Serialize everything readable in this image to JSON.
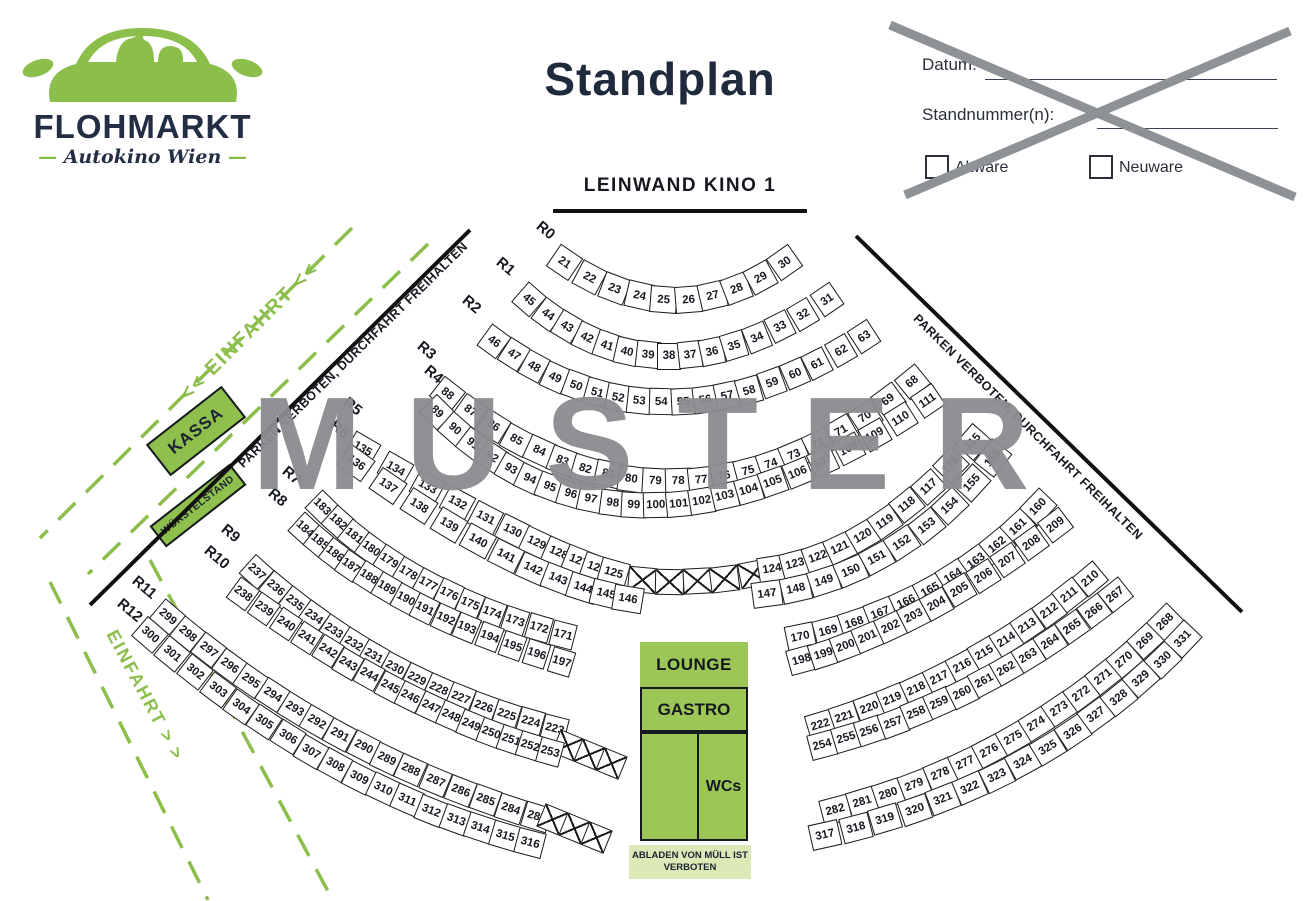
{
  "title": "Standplan",
  "watermark": "MUSTER",
  "screen": {
    "label": "LEINWAND KINO 1"
  },
  "logo": {
    "name": "FLOHMARKT",
    "subtitle": "Autokino Wien"
  },
  "form": {
    "date_label": "Datum:",
    "stand_label": "Standnummer(n):",
    "altware": "Altware",
    "neuware": "Neuware"
  },
  "signs": {
    "kassa": "KASSA",
    "wuerstelstand": "WÜRSTELSTAND",
    "einfahrt_top": "<< EINFAHRT <<",
    "einfahrt_bottom": "EINFAHRT > >",
    "parken_left": "PARKEN VERBOTEN, DURCHFAHRT FREIHALTEN",
    "parken_right": "PARKEN VERBOTEN, DURCHFAHRT FREIHALTEN"
  },
  "facilities": {
    "lounge": "LOUNGE",
    "gastro": "GASTRO",
    "wcs": "WCs",
    "note": "ABLADEN VON MÜLL IST VERBOTEN"
  },
  "colors": {
    "green": "#8cbe4b",
    "block_green": "#9cc655",
    "light_green": "#dbe9b7",
    "navy": "#232e44",
    "gray": "#8a8c8f"
  },
  "row_labels": [
    "R0",
    "R1",
    "R2",
    "R3",
    "R4",
    "R5",
    "R6",
    "R7",
    "R8",
    "R9",
    "R10",
    "R11",
    "R12"
  ],
  "rows": {
    "r0": {
      "cells": [
        21,
        22,
        23,
        24,
        25,
        26,
        27,
        28,
        29,
        30
      ]
    },
    "r1": {
      "cells": [
        45,
        44,
        43,
        42,
        41,
        40,
        39,
        38,
        37,
        36,
        35,
        34,
        33,
        32,
        31
      ]
    },
    "r2": {
      "cells": [
        46,
        47,
        48,
        49,
        50,
        51,
        52,
        53,
        54,
        55,
        56,
        57,
        58,
        59,
        60,
        61,
        62,
        63
      ]
    },
    "r3": {
      "cells": [
        88,
        87,
        86,
        85,
        84,
        83,
        82,
        81,
        80,
        79,
        78,
        77,
        76,
        75,
        74,
        73,
        72,
        71,
        70,
        69,
        68
      ]
    },
    "r4": {
      "cells": [
        89,
        90,
        91,
        92,
        93,
        94,
        95,
        96,
        97,
        98,
        99,
        100,
        101,
        102,
        103,
        104,
        105,
        106,
        107,
        108,
        109,
        110,
        111
      ]
    },
    "r5a": {
      "cells": [
        135,
        134,
        133,
        132,
        131,
        130,
        129,
        128,
        127,
        126,
        125
      ]
    },
    "r5x": {
      "cells": [
        "X",
        "X",
        "X",
        "X",
        "X"
      ]
    },
    "r5b": {
      "cells": [
        124,
        123,
        122,
        121,
        120,
        119,
        118,
        117,
        116,
        115
      ]
    },
    "r6a": {
      "cells": [
        136,
        137,
        138,
        139,
        140,
        141,
        142,
        143,
        144,
        145,
        146
      ]
    },
    "r6b": {
      "cells": [
        147,
        148,
        149,
        150,
        151,
        152,
        153,
        154,
        155,
        156
      ]
    },
    "r7a": {
      "cells": [
        183,
        182,
        181,
        180,
        179,
        178,
        177,
        176,
        175,
        174,
        173,
        172,
        171
      ]
    },
    "r7b": {
      "cells": [
        170,
        169,
        168,
        167,
        166,
        165,
        164,
        163,
        162,
        161,
        160
      ]
    },
    "r8a": {
      "cells": [
        184,
        185,
        186,
        187,
        188,
        189,
        190,
        191,
        192,
        193,
        194,
        195,
        196,
        197
      ]
    },
    "r8b": {
      "cells": [
        198,
        199,
        200,
        201,
        202,
        203,
        204,
        205,
        206,
        207,
        208,
        209
      ]
    },
    "r9a": {
      "cells": [
        237,
        236,
        235,
        234,
        233,
        232,
        231,
        230,
        229,
        228,
        227,
        226,
        225,
        224,
        223
      ]
    },
    "r9x": {
      "cells": [
        "X",
        "X",
        "X"
      ]
    },
    "r9b": {
      "cells": [
        222,
        221,
        220,
        219,
        218,
        217,
        216,
        215,
        214,
        213,
        212,
        211,
        210
      ]
    },
    "r10a": {
      "cells": [
        238,
        239,
        240,
        241,
        242,
        243,
        244,
        245,
        246,
        247,
        248,
        249,
        250,
        251,
        252,
        253
      ]
    },
    "r10b": {
      "cells": [
        254,
        255,
        256,
        257,
        258,
        259,
        260,
        261,
        262,
        263,
        264,
        265,
        266,
        267
      ]
    },
    "r11a": {
      "cells": [
        299,
        298,
        297,
        296,
        295,
        294,
        293,
        292,
        291,
        290,
        289,
        288,
        287,
        286,
        285,
        284,
        283
      ]
    },
    "r11x": {
      "cells": [
        "X",
        "X",
        "X"
      ]
    },
    "r11b": {
      "cells": [
        282,
        281,
        280,
        279,
        278,
        277,
        276,
        275,
        274,
        273,
        272,
        271,
        270,
        269,
        268
      ]
    },
    "r12a": {
      "cells": [
        300,
        301,
        302,
        303,
        304,
        305,
        306,
        307,
        308,
        309,
        310,
        311,
        312,
        313,
        314,
        315,
        316
      ]
    },
    "r12b": {
      "cells": [
        317,
        318,
        319,
        320,
        321,
        322,
        323,
        324,
        325,
        326,
        327,
        328,
        329,
        330,
        331
      ]
    }
  }
}
